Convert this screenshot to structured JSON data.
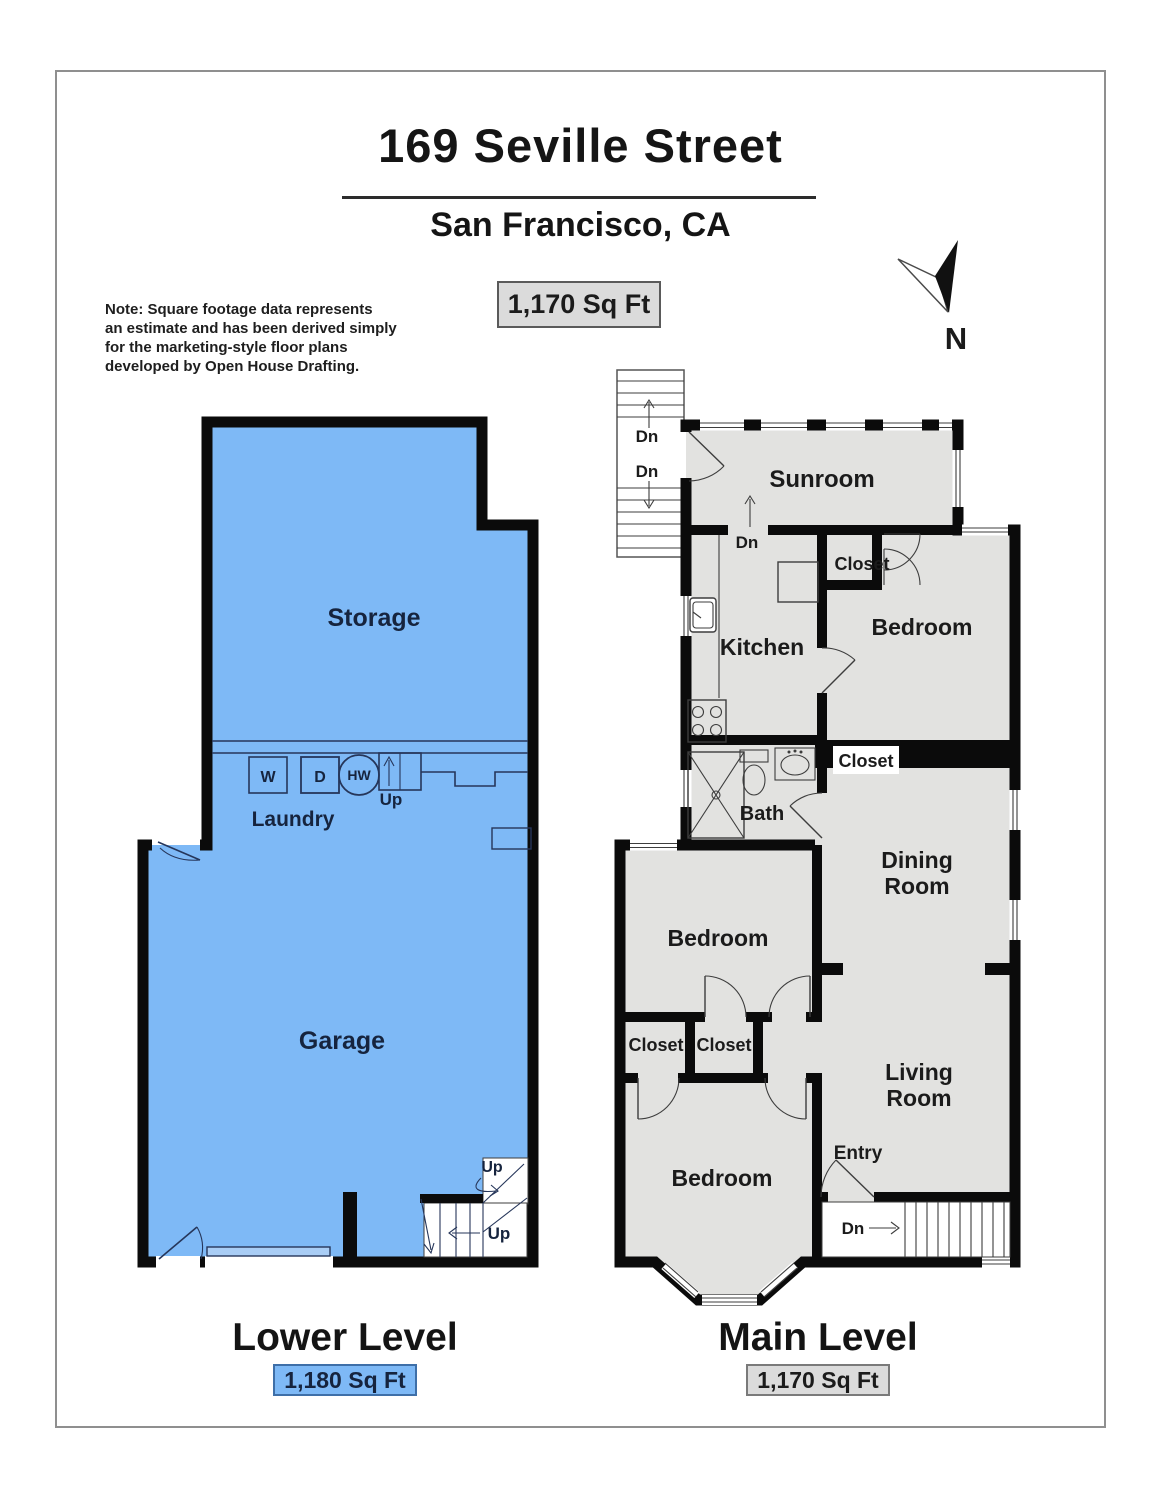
{
  "document": {
    "title": "169 Seville Street",
    "subtitle": "San Francisco, CA",
    "total_sqft_badge": "1,170 Sq Ft",
    "note_lines": [
      "Note: Square footage data represents",
      "an estimate and has been derived simply",
      "for the marketing-style floor plans",
      "developed by Open House Drafting."
    ],
    "compass_label": "N"
  },
  "colors": {
    "lower_fill": "#7EB9F6",
    "main_fill": "#E2E2E0",
    "wall": "#0B0B0B",
    "lower_badge_border": "#3E6FA8",
    "gray_badge_fill": "#DBDBDB",
    "lower_text": "#16243E"
  },
  "lower_level": {
    "title": "Lower Level",
    "sqft_badge": "1,180 Sq Ft",
    "rooms": {
      "storage": "Storage",
      "laundry": "Laundry",
      "garage": "Garage"
    },
    "appliances": {
      "washer": "W",
      "dryer": "D",
      "water_heater": "HW"
    },
    "stair_labels": {
      "laundry_up": "Up",
      "winder_up": "Up",
      "entry_up": "Up"
    }
  },
  "main_level": {
    "title": "Main Level",
    "sqft_badge": "1,170 Sq Ft",
    "rooms": {
      "sunroom": "Sunroom",
      "kitchen": "Kitchen",
      "closet_top": "Closet",
      "bedroom_top": "Bedroom",
      "bath": "Bath",
      "closet_hall": "Closet",
      "dining_room_line1": "Dining",
      "dining_room_line2": "Room",
      "bedroom_mid": "Bedroom",
      "closet_left": "Closet",
      "closet_right": "Closet",
      "living_room_line1": "Living",
      "living_room_line2": "Room",
      "bedroom_bottom": "Bedroom",
      "entry": "Entry"
    },
    "stair_labels": {
      "exterior_upper_dn": "Dn",
      "exterior_lower_dn": "Dn",
      "interior_dn": "Dn",
      "front_dn": "Dn"
    }
  }
}
